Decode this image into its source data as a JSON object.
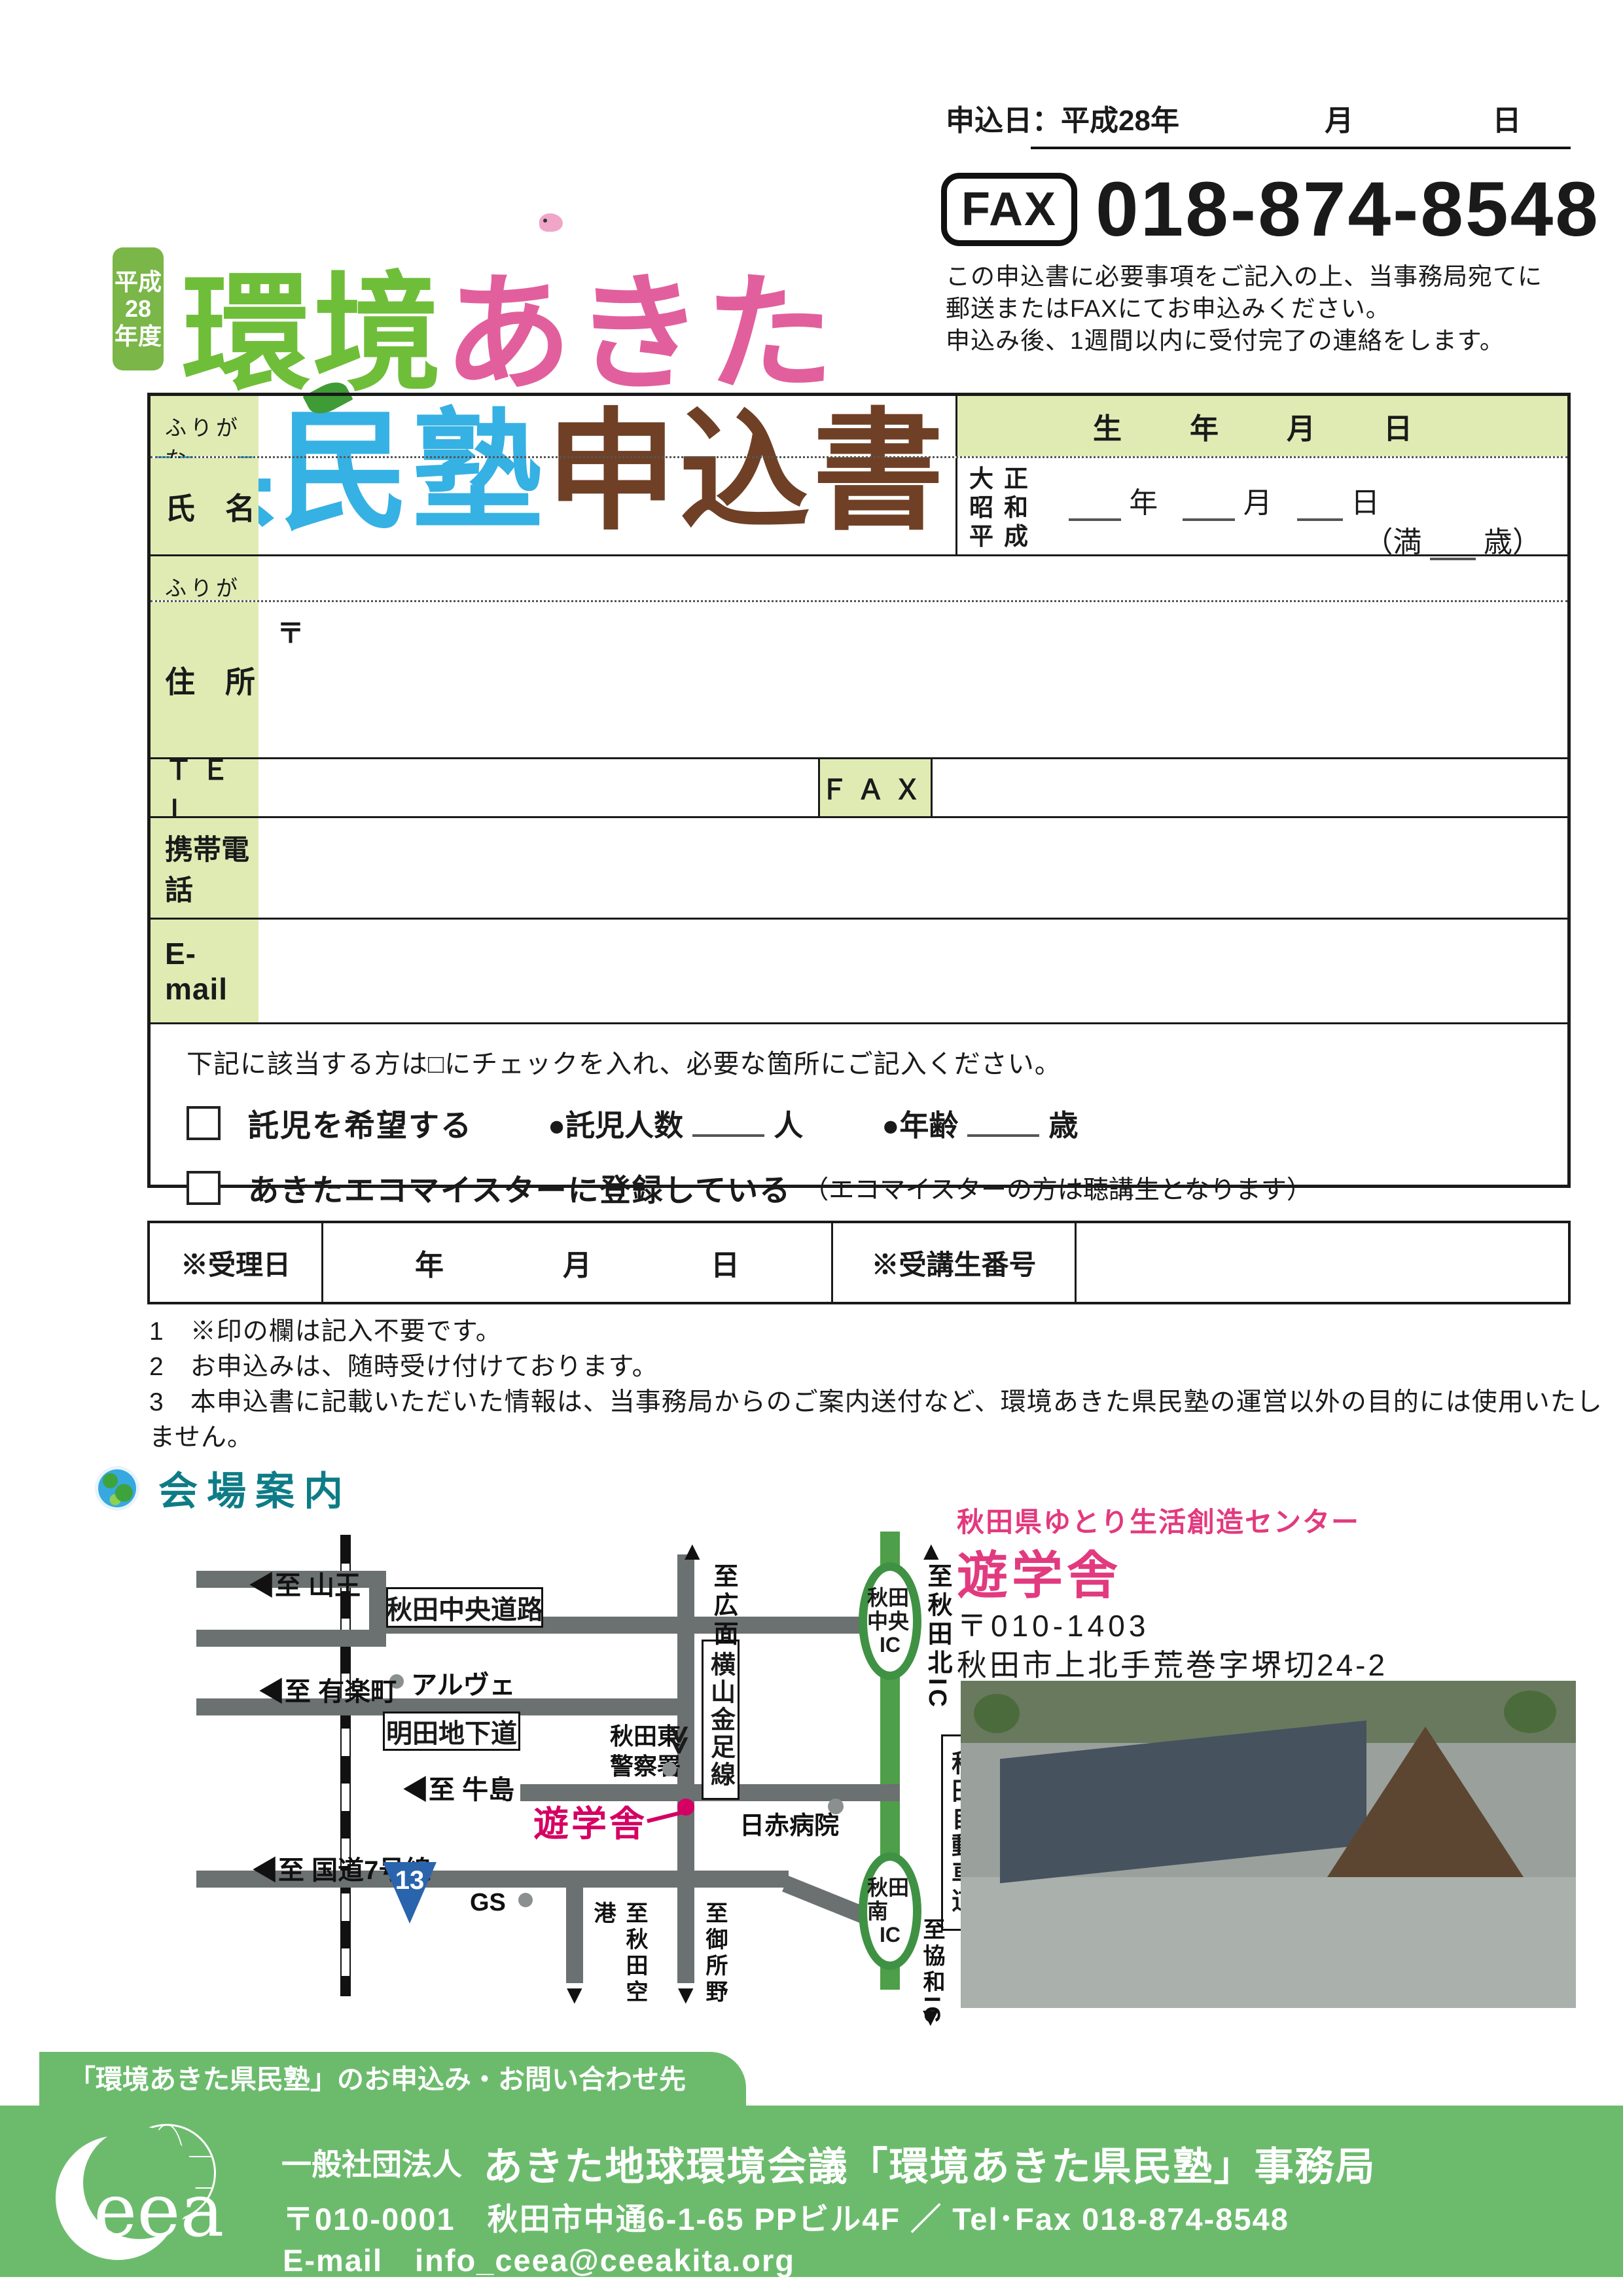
{
  "header": {
    "year_badge_lines": [
      "平成",
      "28",
      "年度"
    ],
    "title_part1": "環境",
    "title_part2": "あきた",
    "title_part3": "県民塾",
    "title_part4": "申込書",
    "apply_date_label": "申込日：平成28年",
    "apply_month": "月",
    "apply_day": "日",
    "fax_badge": "FAX",
    "fax_number": "018-874-8548",
    "instructions": [
      "この申込書に必要事項をご記入の上、当事務局宛てに",
      "郵送またはFAXにてお申込みください。",
      "申込み後、1週間以内に受付完了の連絡をします。"
    ]
  },
  "form": {
    "furigana_label": "ふりがな",
    "name_label": "氏　名",
    "birth_header": "生　年　月　日",
    "birth": {
      "eras": [
        "大正",
        "昭和",
        "平成"
      ],
      "year_suffix": "年",
      "month_suffix": "月",
      "day_suffix": "日",
      "age_prefix": "（満",
      "age_suffix": "歳）"
    },
    "address_label": "住　所",
    "postal_mark": "〒",
    "tel_label": "ＴＥＬ",
    "fax_label": "ＦＡＸ",
    "mobile_label": "携帯電話",
    "email_label": "E-mail"
  },
  "consent": {
    "instruction": "下記に該当する方は□にチェックを入れ、必要な箇所にご記入ください。",
    "childcare_label": "託児を希望する",
    "childcare_count_label": "●託児人数",
    "count_unit": "人",
    "age_label": "●年齢",
    "age_unit": "歳",
    "ecomeister_label": "あきたエコマイスターに登録している",
    "ecomeister_note": "（エコマイスターの方は聴講生となります）"
  },
  "office_table": {
    "receipt_label": "※受理日",
    "date_parts": [
      "年",
      "月",
      "日"
    ],
    "number_label": "※受講生番号"
  },
  "notes": [
    "1　※印の欄は記入不要です。",
    "2　お申込みは、随時受け付けております。",
    "3　本申込書に記載いただいた情報は、当事務局からのご案内送付など、環境あきた県民塾の運営以外の目的には使用いたしません。"
  ],
  "venue": {
    "heading": "会場案内",
    "center_name": "秋田県ゆとり生活創造センター",
    "center_title": "遊学舎",
    "postal": "〒010-1403",
    "address": "秋田市上北手荒巻字堺切24-2"
  },
  "map": {
    "sanno": "◀至 山王",
    "chuo_road": "秋田中央道路",
    "alve": "アルヴェ",
    "yurakucho": "◀至 有楽町",
    "myoden": "明田地下道",
    "police_line1": "秋田東",
    "police_line2": "警察署",
    "hiromen": "至広面",
    "kanaashi": "横山金足線",
    "kita_ic": "至秋田北IC",
    "chuo_ic_line1": "秋田中央",
    "chuo_ic_line2": "IC",
    "expressway": "秋田自動車道",
    "ushijima": "◀至 牛島",
    "yugakusha": "遊学舎",
    "nisseki": "日赤病院",
    "route7": "◀至 国道7号線",
    "route13": "13",
    "gs": "GS",
    "airport": "至秋田空港",
    "goshono": "至御所野",
    "minami_ic_line1": "秋田南",
    "minami_ic_line2": "IC",
    "kyowa": "至協和IC",
    "arrow_up": "▲",
    "arrow_down": "▼",
    "chevron": "≫"
  },
  "footer": {
    "tab": "「環境あきた県民塾」のお申込み・お問い合わせ先",
    "logo_text": "eea",
    "org_prefix": "一般社団法人",
    "org_name": "あきた地球環境会議「環境あきた県民塾」事務局",
    "address_line": "〒010-0001　秋田市中通6-1-65 PPビル4F ／ Tel･Fax 018-874-8548",
    "email_line": "E-mail　info_ceea@ceeakita.org"
  },
  "colors": {
    "title_green": "#6fbe3a",
    "title_pink": "#e25f9d",
    "title_blue": "#36b1e3",
    "title_brown": "#6f4026",
    "label_cell_green": "#e0ebb4",
    "heading_teal": "#0e7c86",
    "map_red": "#d50063",
    "highway_green": "#4f9e49",
    "footer_green": "#6cbb6d",
    "route13_blue": "#2a64ad"
  }
}
